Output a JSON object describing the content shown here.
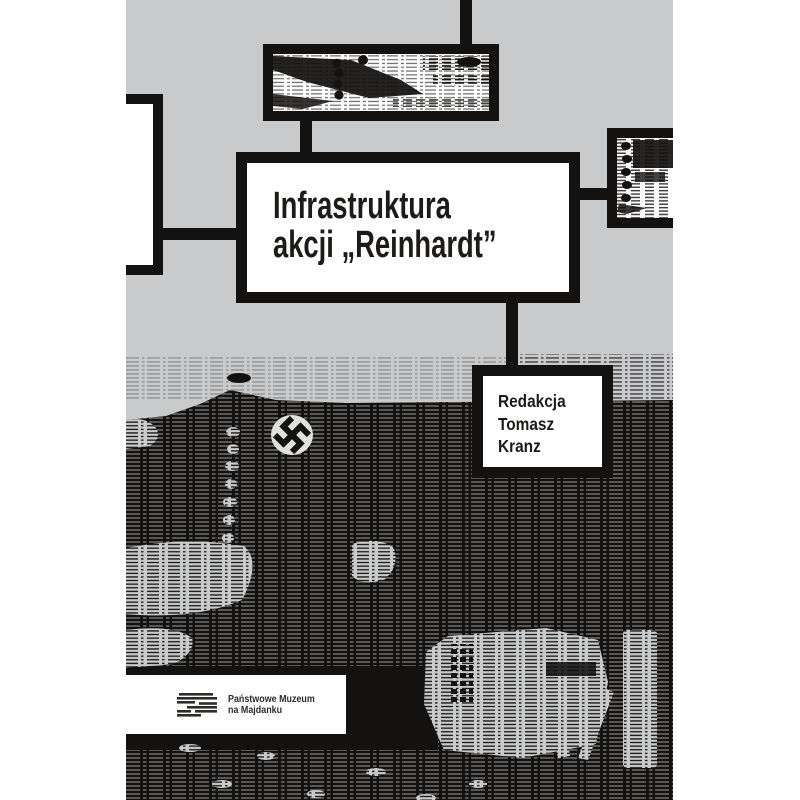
{
  "cover": {
    "background_color": "#c9cacb",
    "ink_color": "#141210",
    "page_color": "#ffffff",
    "title": {
      "line1": "Infrastruktura",
      "line2": "akcji „Reinhardt”",
      "color": "#1d1b18"
    },
    "editor": {
      "line1": "Redakcja",
      "line2": "Tomasz",
      "line3": "Kranz"
    },
    "publisher": {
      "line1": "Państwowe Muzeum",
      "line2": "na Majdanku"
    },
    "icons": {
      "logo": "majdanek-logo-icon",
      "photo_top": "halftone-archive-photo-strip",
      "photo_right": "halftone-archive-photo-strip",
      "photo_main": "halftone-photo-building-with-banner"
    }
  }
}
